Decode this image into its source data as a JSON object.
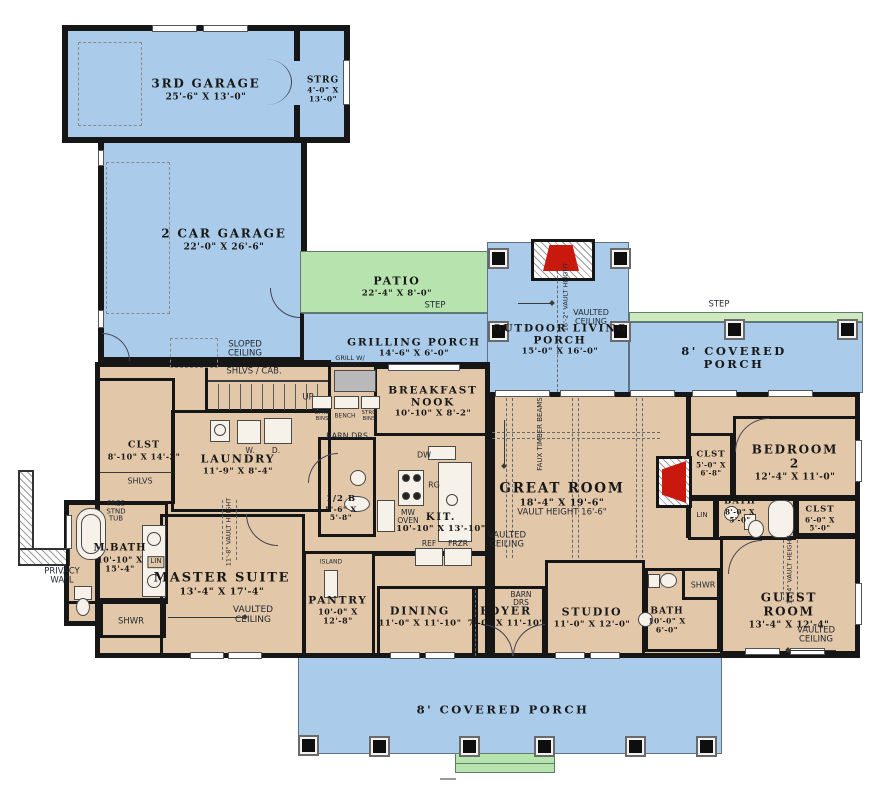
{
  "colors": {
    "porch_blue": "#aacbe9",
    "patio_green": "#b7e4ae",
    "interior_tan": "#e3c7a9",
    "wall_black": "#161616",
    "fireplace_red": "#c9180e",
    "step_green": "#cde9bd"
  },
  "rooms": {
    "third_garage": {
      "name": "3RD GARAGE",
      "dims": "25'-6\" X 13'-0\""
    },
    "strg": {
      "name": "STRG",
      "dims": "4'-0\" X\n13'-0\""
    },
    "two_car_garage": {
      "name": "2 CAR GARAGE",
      "dims": "22'-0\" X 26'-6\""
    },
    "patio": {
      "name": "PATIO",
      "dims": "22'-4\" X 8'-0\""
    },
    "grilling_porch": {
      "name": "GRILLING PORCH",
      "dims": "14'-6\" X 6'-0\""
    },
    "outdoor_living_porch": {
      "name": "OUTDOOR LIVING\nPORCH",
      "dims": "15'-0\" X 16'-0\""
    },
    "covered_porch_right": {
      "name": "8' COVERED PORCH"
    },
    "covered_porch_bottom": {
      "name": "8' COVERED PORCH"
    },
    "breakfast_nook": {
      "name": "BREAKFAST\nNOOK",
      "dims": "10'-10\" X 8'-2\""
    },
    "laundry": {
      "name": "LAUNDRY",
      "dims": "11'-9\" X 8'-4\""
    },
    "master_closet": {
      "name": "CLST",
      "dims": "8'-10\" X 14'-2\""
    },
    "half_bath": {
      "name": "1/2 B",
      "dims": "5'-6\" X\n5'-8\""
    },
    "kitchen": {
      "name": "KIT.",
      "dims": "10'-10\" X 13'-10\""
    },
    "great_room": {
      "name": "GREAT ROOM",
      "dims": "18'-4\" X 19'-6\"",
      "note": "VAULT HEIGHT 16'-6\""
    },
    "m_bath": {
      "name": "M.BATH",
      "dims": "10'-10\" X\n15'-4\""
    },
    "master_suite": {
      "name": "MASTER SUITE",
      "dims": "13'-4\" X 17'-4\""
    },
    "pantry": {
      "name": "PANTRY",
      "dims": "10'-0\" X\n12'-8\""
    },
    "dining": {
      "name": "DINING",
      "dims": "11'-0\" X 11'-10\""
    },
    "foyer": {
      "name": "FOYER",
      "dims": "7'-0\" X 11'-10\""
    },
    "studio": {
      "name": "STUDIO",
      "dims": "11'-0\" X 12'-0\""
    },
    "studio_bath": {
      "name": "BATH",
      "dims": "10'-0\" X\n6'-0\""
    },
    "guest_room": {
      "name": "GUEST ROOM",
      "dims": "13'-4\" X 12'-4\""
    },
    "bedroom_2": {
      "name": "BEDROOM 2",
      "dims": "12'-4\" X 11'-0\""
    },
    "bedroom2_closet": {
      "name": "CLST",
      "dims": "5'-0\" X\n6'-8\""
    },
    "bedroom2_bath": {
      "name": "BATH",
      "dims": "8'-0\" X\n5'-0\""
    },
    "hall_closet": {
      "name": "CLST",
      "dims": "6'-0\" X\n5'-0\""
    }
  },
  "ann": {
    "step_patio": "STEP",
    "step_right": "STEP",
    "sloped_ceiling": "SLOPED\nCEILING",
    "shlvs_cab": "SHLVS / CAB.",
    "up": "UP",
    "shlvs": "SHLVS",
    "barn_drs_hall": "BARN DRS",
    "barn_drs_foyer": "BARN\nDRS",
    "grill": "GRILL W/\nHOOD",
    "strg_bins_left": "STRG\nBINS",
    "bench": "BENCH",
    "strg_bins_right": "STRG\nBINS",
    "dw": "DW",
    "rg": "RG",
    "mw_oven": "MW\nOVEN",
    "ref": "REF",
    "frzr": "FRZR",
    "washer": "W.",
    "dryer": "D.",
    "free_stnd_tub": "FREE\nSTND\nTUB",
    "lin_mbath": "LIN",
    "lin_bed2": "LIN",
    "shwr_master": "SHWR",
    "shwr_studio": "SHWR",
    "privacy_wall": "PRIVACY\nWALL",
    "island": "ISLAND",
    "faux_timber_beams": "FAUX TIMBER BEAMS",
    "vaulted_ceiling_porch": "VAULTED\nCEILING",
    "vaulted_ceiling_great": "VAULTED\nCEILING",
    "vaulted_ceiling_master": "VAULTED\nCEILING",
    "vaulted_ceiling_guest": "VAULTED\nCEILING",
    "vault_height_porch": "16'-2\" VAULT HEIGHT",
    "vault_height_master": "11'-8\" VAULT HEIGHT",
    "vault_height_guest": "11'-4\" VAULT HEIGHT"
  }
}
